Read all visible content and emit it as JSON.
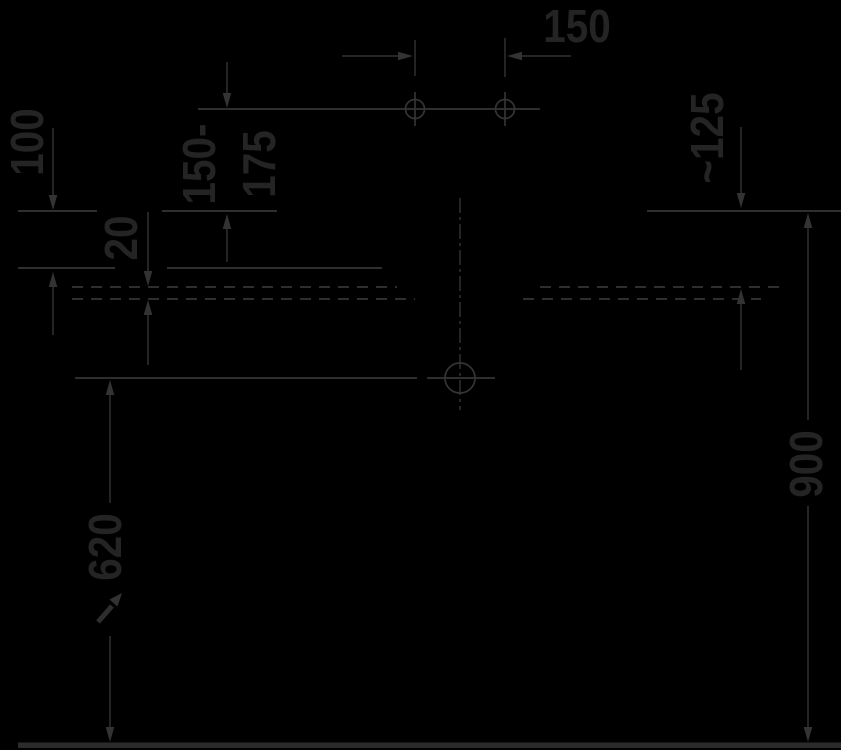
{
  "drawing": {
    "kind": "sanitary-installation-dimension-drawing",
    "background_color": "#000000",
    "line_color": "#343434",
    "text_color": "#242424",
    "units": "mm"
  },
  "labels": {
    "dim_150": "150",
    "dim_150_175": {
      "line1": "150-",
      "line2": "175"
    },
    "dim_100": "100",
    "dim_20": "20",
    "dim_125": "~125",
    "dim_620": "620",
    "dim_900": "900"
  }
}
